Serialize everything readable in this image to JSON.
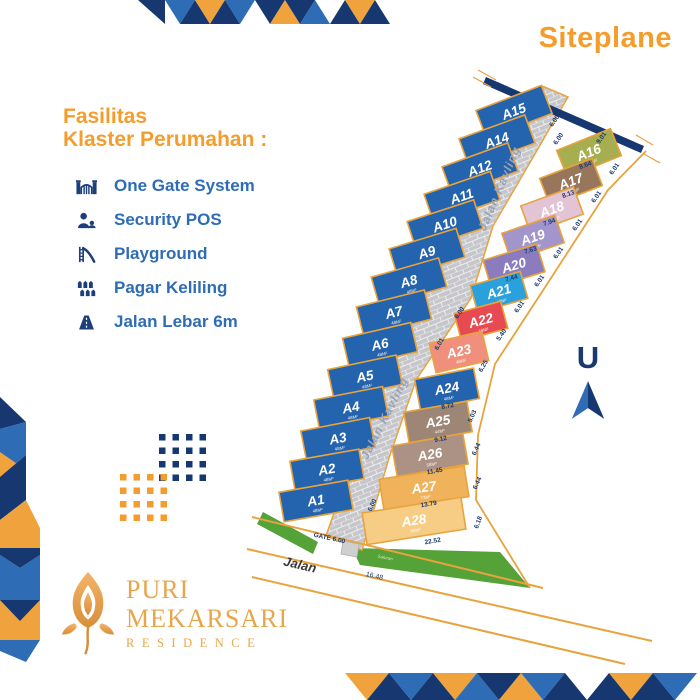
{
  "title": "Siteplane",
  "facilities": {
    "heading_line1": "Fasilitas",
    "heading_line2": "Klaster Perumahan :",
    "items": [
      {
        "icon": "gate-icon",
        "label": "One Gate System"
      },
      {
        "icon": "security-icon",
        "label": "Security POS"
      },
      {
        "icon": "playground-icon",
        "label": "Playground"
      },
      {
        "icon": "fence-icon",
        "label": "Pagar Keliling"
      },
      {
        "icon": "road-icon",
        "label": "Jalan Lebar 6m"
      }
    ]
  },
  "north": {
    "label": "U"
  },
  "logo": {
    "line1": "PURI",
    "line2": "MEKARSARI",
    "line3": "RESIDENCE"
  },
  "colors": {
    "accent_orange": "#f59d2c",
    "navy": "#16376f",
    "blue": "#2e6cb5",
    "lot_blue": "#2463ae",
    "stroke_orange": "#e8a33d",
    "road_gray": "#c7c7cb",
    "mortar": "#ebedef",
    "green": "#55a238",
    "gate_gray": "#cfcfcf",
    "dim_navy": "#1a3a6e",
    "road_label_gray": "#9aa3b5",
    "gold": "#e7a64b"
  },
  "map": {
    "road": {
      "points": [
        [
          542,
          86
        ],
        [
          568,
          97
        ],
        [
          493,
          226
        ],
        [
          471,
          298
        ],
        [
          416,
          380
        ],
        [
          389,
          458
        ],
        [
          362,
          550
        ],
        [
          326,
          536
        ],
        [
          355,
          452
        ],
        [
          376,
          380
        ],
        [
          425,
          292
        ],
        [
          452,
          218
        ]
      ]
    },
    "road_labels": [
      {
        "t": "Jalan Kavling",
        "x": 503,
        "y": 190,
        "a": -67
      },
      {
        "t": "Jalan Kavling",
        "x": 388,
        "y": 420,
        "a": -63
      }
    ],
    "wall": {
      "points": [
        [
          486,
          77
        ],
        [
          644,
          146
        ],
        [
          641,
          153
        ],
        [
          483,
          84
        ]
      ]
    },
    "ticks": [
      [
        478,
        70,
        496,
        80
      ],
      [
        473,
        77,
        491,
        87
      ],
      [
        636,
        135,
        653,
        145
      ],
      [
        644,
        154,
        660,
        163
      ]
    ],
    "boundary_lines": [
      [
        252,
        517,
        543,
        588
      ],
      [
        247,
        549,
        652,
        641
      ],
      [
        252,
        577,
        625,
        664
      ]
    ],
    "boundary_right": [
      [
        646,
        151
      ],
      [
        608,
        190
      ],
      [
        553,
        275
      ],
      [
        495,
        364
      ],
      [
        478,
        435
      ],
      [
        476,
        500
      ],
      [
        530,
        588
      ]
    ],
    "greens": [
      [
        [
          263,
          512
        ],
        [
          318,
          542
        ],
        [
          313,
          554
        ],
        [
          257,
          524
        ]
      ],
      [
        [
          352,
          548
        ],
        [
          500,
          552
        ],
        [
          530,
          588
        ],
        [
          360,
          565
        ]
      ]
    ],
    "gate_box": [
      [
        343,
        541
      ],
      [
        359,
        544
      ],
      [
        357,
        557
      ],
      [
        341,
        554
      ]
    ],
    "plots": [
      {
        "label": "A15",
        "area": "48M²",
        "x": 514,
        "y": 112,
        "w": 70,
        "h": 30,
        "a": -21,
        "c": "#2463ae"
      },
      {
        "label": "A14",
        "area": "48M²",
        "x": 497,
        "y": 141,
        "w": 70,
        "h": 30,
        "a": -20,
        "c": "#2463ae"
      },
      {
        "label": "A12",
        "area": "48M²",
        "x": 480,
        "y": 169,
        "w": 70,
        "h": 30,
        "a": -20,
        "c": "#2463ae"
      },
      {
        "label": "A11",
        "area": "48M²",
        "x": 462,
        "y": 197,
        "w": 70,
        "h": 30,
        "a": -19,
        "c": "#2463ae"
      },
      {
        "label": "A10",
        "area": "48M²",
        "x": 445,
        "y": 225,
        "w": 70,
        "h": 30,
        "a": -18,
        "c": "#2463ae"
      },
      {
        "label": "A9",
        "area": "48M²",
        "x": 427,
        "y": 253,
        "w": 70,
        "h": 30,
        "a": -17,
        "c": "#2463ae"
      },
      {
        "label": "A8",
        "area": "48M²",
        "x": 409,
        "y": 282,
        "w": 70,
        "h": 30,
        "a": -16,
        "c": "#2463ae"
      },
      {
        "label": "A7",
        "area": "48M²",
        "x": 394,
        "y": 313,
        "w": 70,
        "h": 30,
        "a": -14,
        "c": "#2463ae"
      },
      {
        "label": "A6",
        "area": "48M²",
        "x": 380,
        "y": 345,
        "w": 70,
        "h": 30,
        "a": -13,
        "c": "#2463ae"
      },
      {
        "label": "A5",
        "area": "48M²",
        "x": 365,
        "y": 377,
        "w": 70,
        "h": 30,
        "a": -12,
        "c": "#2463ae"
      },
      {
        "label": "A4",
        "area": "48M²",
        "x": 351,
        "y": 408,
        "w": 70,
        "h": 30,
        "a": -11,
        "c": "#2463ae"
      },
      {
        "label": "A3",
        "area": "48M²",
        "x": 338,
        "y": 439,
        "w": 70,
        "h": 30,
        "a": -11,
        "c": "#2463ae"
      },
      {
        "label": "A2",
        "area": "48M²",
        "x": 327,
        "y": 470,
        "w": 70,
        "h": 30,
        "a": -10,
        "c": "#2463ae"
      },
      {
        "label": "A1",
        "area": "48M²",
        "x": 316,
        "y": 501,
        "w": 70,
        "h": 30,
        "a": -10,
        "c": "#2463ae"
      },
      {
        "label": "A16",
        "area": "48M²",
        "x": 589,
        "y": 153,
        "w": 58,
        "h": 29,
        "a": -22,
        "c": "#a7ae4f"
      },
      {
        "label": "A17",
        "area": "48M²",
        "x": 571,
        "y": 182,
        "w": 56,
        "h": 29,
        "a": -21,
        "c": "#97765b"
      },
      {
        "label": "A18",
        "area": "48M²",
        "x": 552,
        "y": 210,
        "w": 56,
        "h": 29,
        "a": -20,
        "c": "#e3c4d4"
      },
      {
        "label": "A19",
        "area": "48M²",
        "x": 533,
        "y": 238,
        "w": 56,
        "h": 29,
        "a": -19,
        "c": "#a295cb"
      },
      {
        "label": "A20",
        "area": "48M²",
        "x": 514,
        "y": 266,
        "w": 56,
        "h": 29,
        "a": -17,
        "c": "#8a7cbd"
      },
      {
        "label": "A21",
        "area": "48M²",
        "x": 499,
        "y": 292,
        "w": 52,
        "h": 28,
        "a": -16,
        "c": "#2aa0dc"
      },
      {
        "label": "A22",
        "area": "48M²",
        "x": 481,
        "y": 321,
        "w": 48,
        "h": 28,
        "a": -15,
        "c": "#e84a52"
      },
      {
        "label": "A23",
        "area": "48M²",
        "x": 459,
        "y": 352,
        "w": 54,
        "h": 30,
        "a": -13,
        "c": "#f0907c"
      },
      {
        "label": "A24",
        "area": "48M²",
        "x": 447,
        "y": 389,
        "w": 60,
        "h": 31,
        "a": -11,
        "c": "#2463ae"
      },
      {
        "label": "A25",
        "area": "44M²",
        "x": 438,
        "y": 422,
        "w": 64,
        "h": 31,
        "a": -10,
        "c": "#9d8676"
      },
      {
        "label": "A26",
        "area": "58M²",
        "x": 430,
        "y": 455,
        "w": 72,
        "h": 31,
        "a": -10,
        "c": "#ab9284"
      },
      {
        "label": "A27",
        "area": "73M²",
        "x": 424,
        "y": 488,
        "w": 86,
        "h": 31,
        "a": -9,
        "c": "#f0b35c"
      },
      {
        "label": "A28",
        "area": "85M²",
        "x": 414,
        "y": 521,
        "w": 100,
        "h": 32,
        "a": -9,
        "c": "#f7cd85"
      }
    ],
    "dims": [
      {
        "t": "6.00",
        "x": 556,
        "y": 122,
        "a": -55
      },
      {
        "t": "6.00",
        "x": 560,
        "y": 140,
        "a": -55
      },
      {
        "t": "9.01",
        "x": 603,
        "y": 139,
        "a": -55
      },
      {
        "t": "8.64",
        "x": 586,
        "y": 167,
        "a": -20
      },
      {
        "t": "6.01",
        "x": 616,
        "y": 170,
        "a": -55
      },
      {
        "t": "8.13",
        "x": 569,
        "y": 196,
        "a": -20
      },
      {
        "t": "6.01",
        "x": 598,
        "y": 198,
        "a": -55
      },
      {
        "t": "7.94",
        "x": 550,
        "y": 224,
        "a": -20
      },
      {
        "t": "6.01",
        "x": 579,
        "y": 226,
        "a": -55
      },
      {
        "t": "7.63",
        "x": 531,
        "y": 252,
        "a": -18
      },
      {
        "t": "6.01",
        "x": 560,
        "y": 254,
        "a": -55
      },
      {
        "t": "7.44",
        "x": 512,
        "y": 280,
        "a": -17
      },
      {
        "t": "6.01",
        "x": 541,
        "y": 282,
        "a": -55
      },
      {
        "t": "6.01",
        "x": 521,
        "y": 308,
        "a": -55
      },
      {
        "t": "6.00",
        "x": 461,
        "y": 314,
        "a": -55
      },
      {
        "t": "5.40",
        "x": 503,
        "y": 336,
        "a": -55
      },
      {
        "t": "6.01",
        "x": 441,
        "y": 345,
        "a": -60
      },
      {
        "t": "6.25",
        "x": 485,
        "y": 367,
        "a": -60
      },
      {
        "t": "8.72",
        "x": 448,
        "y": 408,
        "a": -11
      },
      {
        "t": "5.03",
        "x": 474,
        "y": 417,
        "a": -65
      },
      {
        "t": "9.12",
        "x": 441,
        "y": 441,
        "a": -11
      },
      {
        "t": "6.44",
        "x": 478,
        "y": 450,
        "a": -65
      },
      {
        "t": "11.45",
        "x": 435,
        "y": 473,
        "a": -10
      },
      {
        "t": "6.44",
        "x": 479,
        "y": 484,
        "a": -65
      },
      {
        "t": "13.79",
        "x": 429,
        "y": 506,
        "a": -10
      },
      {
        "t": "6.18",
        "x": 480,
        "y": 523,
        "a": -70
      },
      {
        "t": "22.52",
        "x": 433,
        "y": 543,
        "a": -10
      },
      {
        "t": "6.00",
        "x": 374,
        "y": 506,
        "a": -65
      }
    ],
    "texts": [
      {
        "t": "Jalan",
        "x": 299,
        "y": 569,
        "a": 13,
        "s": 13,
        "c": "#3b3b3b",
        "fw": "bold",
        "fs": "italic",
        "name": "bottom-road-label"
      },
      {
        "t": "GATE 6.00",
        "x": 329,
        "y": 540,
        "a": 12,
        "s": 6.5,
        "c": "#1a3a6e",
        "fw": "bold",
        "fs": "normal",
        "name": "gate-label"
      },
      {
        "t": "16.48",
        "x": 374,
        "y": 578,
        "a": 13,
        "s": 7,
        "c": "#1a3a6e",
        "fw": "normal",
        "fs": "normal",
        "name": "frontage-dim"
      },
      {
        "t": "Saluran",
        "x": 385,
        "y": 559,
        "a": 11,
        "s": 4.5,
        "c": "#d7e8bd",
        "fw": "normal",
        "fs": "italic",
        "name": "drain-label"
      }
    ]
  }
}
